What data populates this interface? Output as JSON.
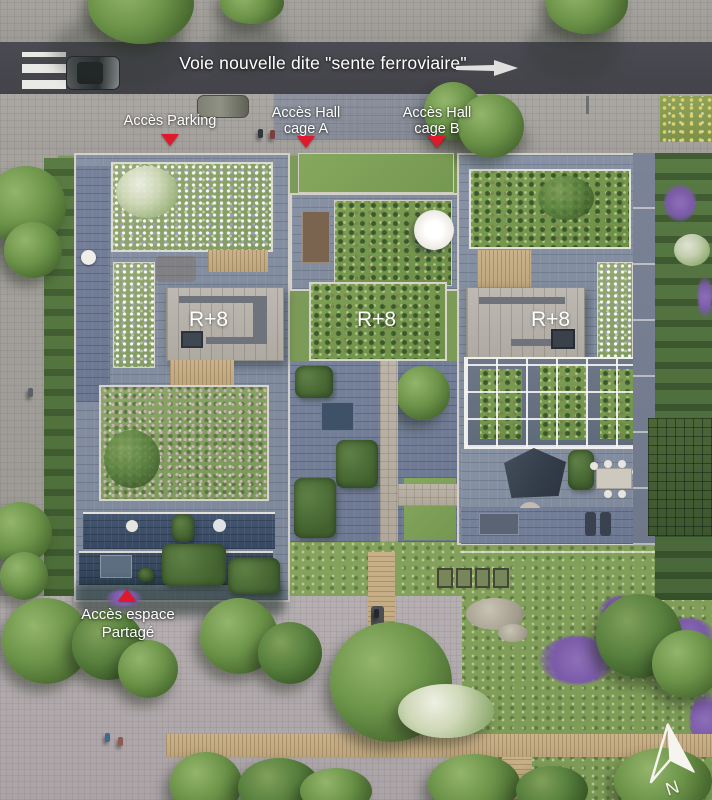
{
  "scene": {
    "description": "Aerial architectural site plan of a residential development with three R+8 buildings, roof gardens and a shared landscaped garden",
    "street_label": "Voie nouvelle dite \"sente ferroviaire\"",
    "compass_label": "N"
  },
  "markers": {
    "parking": {
      "label": "Accès Parking"
    },
    "hall_a": {
      "line1": "Accès Hall",
      "line2": "cage A"
    },
    "hall_b": {
      "line1": "Accès Hall",
      "line2": "cage B"
    },
    "shared_space": {
      "line1": "Accès espace",
      "line2": "Partagé"
    }
  },
  "buildings": {
    "left": {
      "level": "R+8"
    },
    "middle": {
      "level": "R+8"
    },
    "right": {
      "level": "R+8"
    }
  },
  "colors": {
    "marker_red": "#e0182b",
    "label_text": "#ffffff",
    "road_asphalt": "#47474f",
    "sidewalk_grey": "#a3a09c",
    "plaza_paving": "#b2abae",
    "roof_pavers_blue_grey": "#8490a2",
    "tower_roof_grey": "#b6b2ab",
    "green_roof": "#85a061",
    "meadow_green": "#82a05a",
    "boardwalk_wood": "#c4ae88",
    "terrace_slate": "#3e5068",
    "tree_canopy": "#5f8748",
    "purple_flowers": "#8a6fb5"
  }
}
